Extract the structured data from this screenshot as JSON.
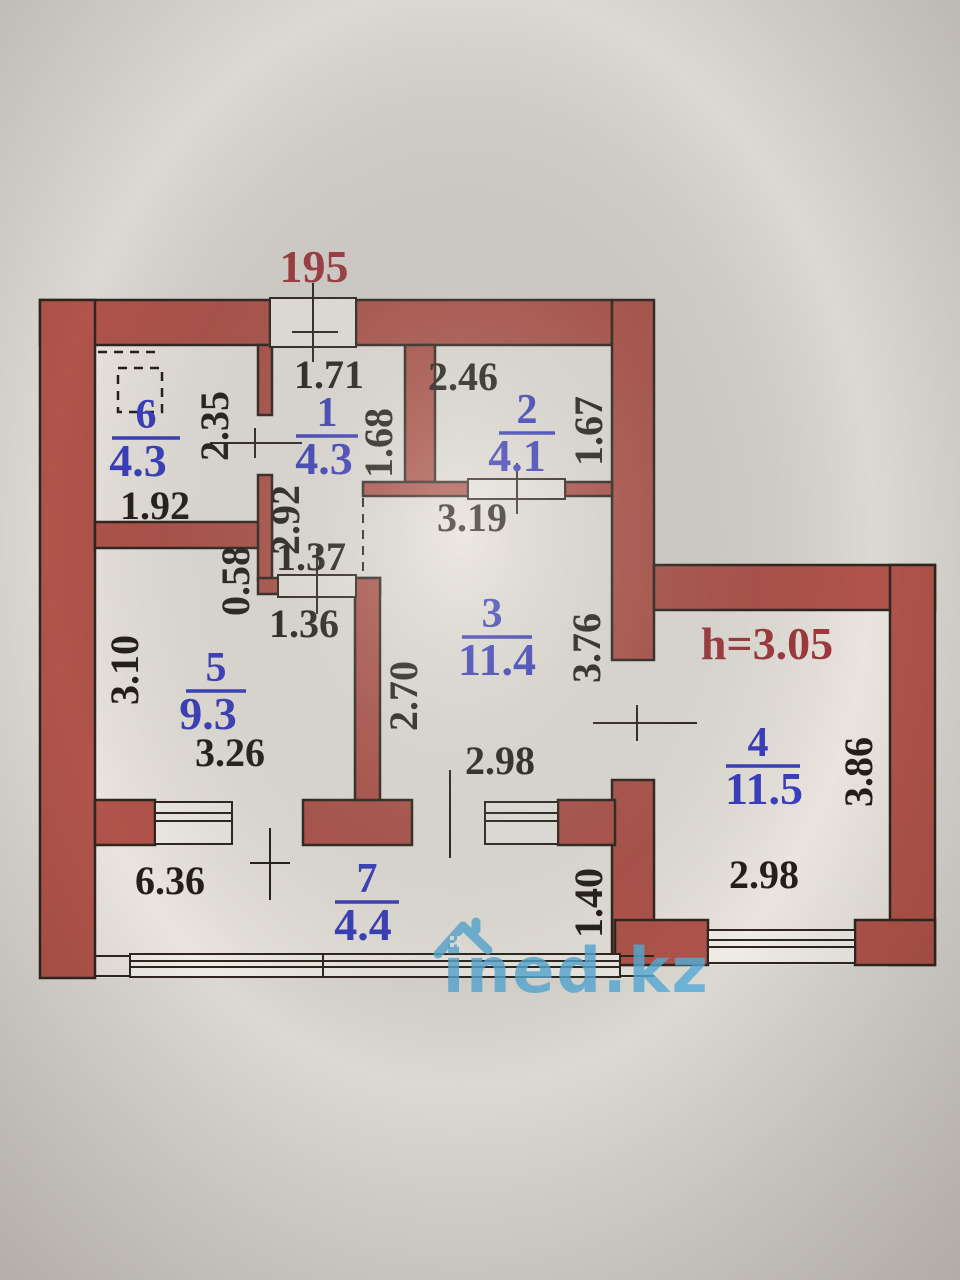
{
  "labels": {
    "plan_number": "195",
    "ceiling_height": "h=3.05"
  },
  "rooms": {
    "r1": {
      "number": "1",
      "area": "4.3"
    },
    "r2": {
      "number": "2",
      "area": "4.1"
    },
    "r3": {
      "number": "3",
      "area": "11.4"
    },
    "r4": {
      "number": "4",
      "area": "11.5"
    },
    "r5": {
      "number": "5",
      "area": "9.3"
    },
    "r6": {
      "number": "6",
      "area": "4.3"
    },
    "r7": {
      "number": "7",
      "area": "4.4"
    }
  },
  "dims": {
    "entry_width": "1.71",
    "room2_width_top": "2.46",
    "room6_depth": "2.35",
    "room1_depth": "1.68",
    "room2_depth": "1.67",
    "room6_width": "1.92",
    "hall_depth": "2.92",
    "room3_width_top": "3.19",
    "hall_width": "1.37",
    "wall_stub": "0.58",
    "hall_width_bottom": "1.36",
    "room5_depth": "3.10",
    "room3_depth_left": "2.70",
    "room3_depth_right": "3.76",
    "room5_width": "3.26",
    "room3_width_bottom": "2.98",
    "balcony_width": "6.36",
    "balcony_depth": "1.40",
    "room4_width": "2.98",
    "room4_depth": "3.86"
  },
  "watermark": {
    "text": "ined.kz",
    "icon": "house-icon"
  },
  "colors": {
    "wall": "#b1544b",
    "outline": "#2e261f",
    "room_text": "#3a3fbf",
    "red_text": "#a13a3e",
    "dim_text": "#241f1a",
    "watermark": "#58acd7"
  }
}
